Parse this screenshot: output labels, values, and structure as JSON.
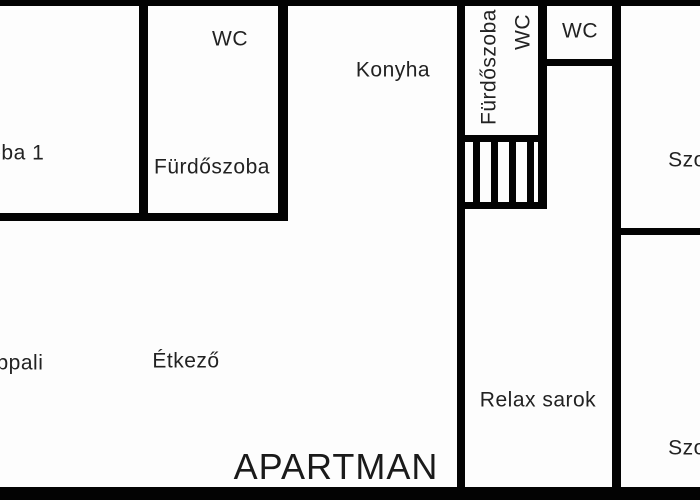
{
  "plan": {
    "title": "APARTMAN",
    "labels": {
      "szoba1": "Szoba 1",
      "wc_left": "WC",
      "furdoszoba_left": "Fürdőszoba",
      "konyha": "Konyha",
      "furdoszoba_vertical": "Fürdőszoba",
      "wc_vertical": "WC",
      "wc_top": "WC",
      "szoba_top_right": "Szo",
      "nappali": "Nappali",
      "etkezo": "Étkező",
      "relax_sarok": "Relax sarok",
      "szoba_bottom_right": "Szo"
    },
    "colors": {
      "wall": "#030303",
      "text": "#222222",
      "background": "#fdfdfd"
    }
  }
}
